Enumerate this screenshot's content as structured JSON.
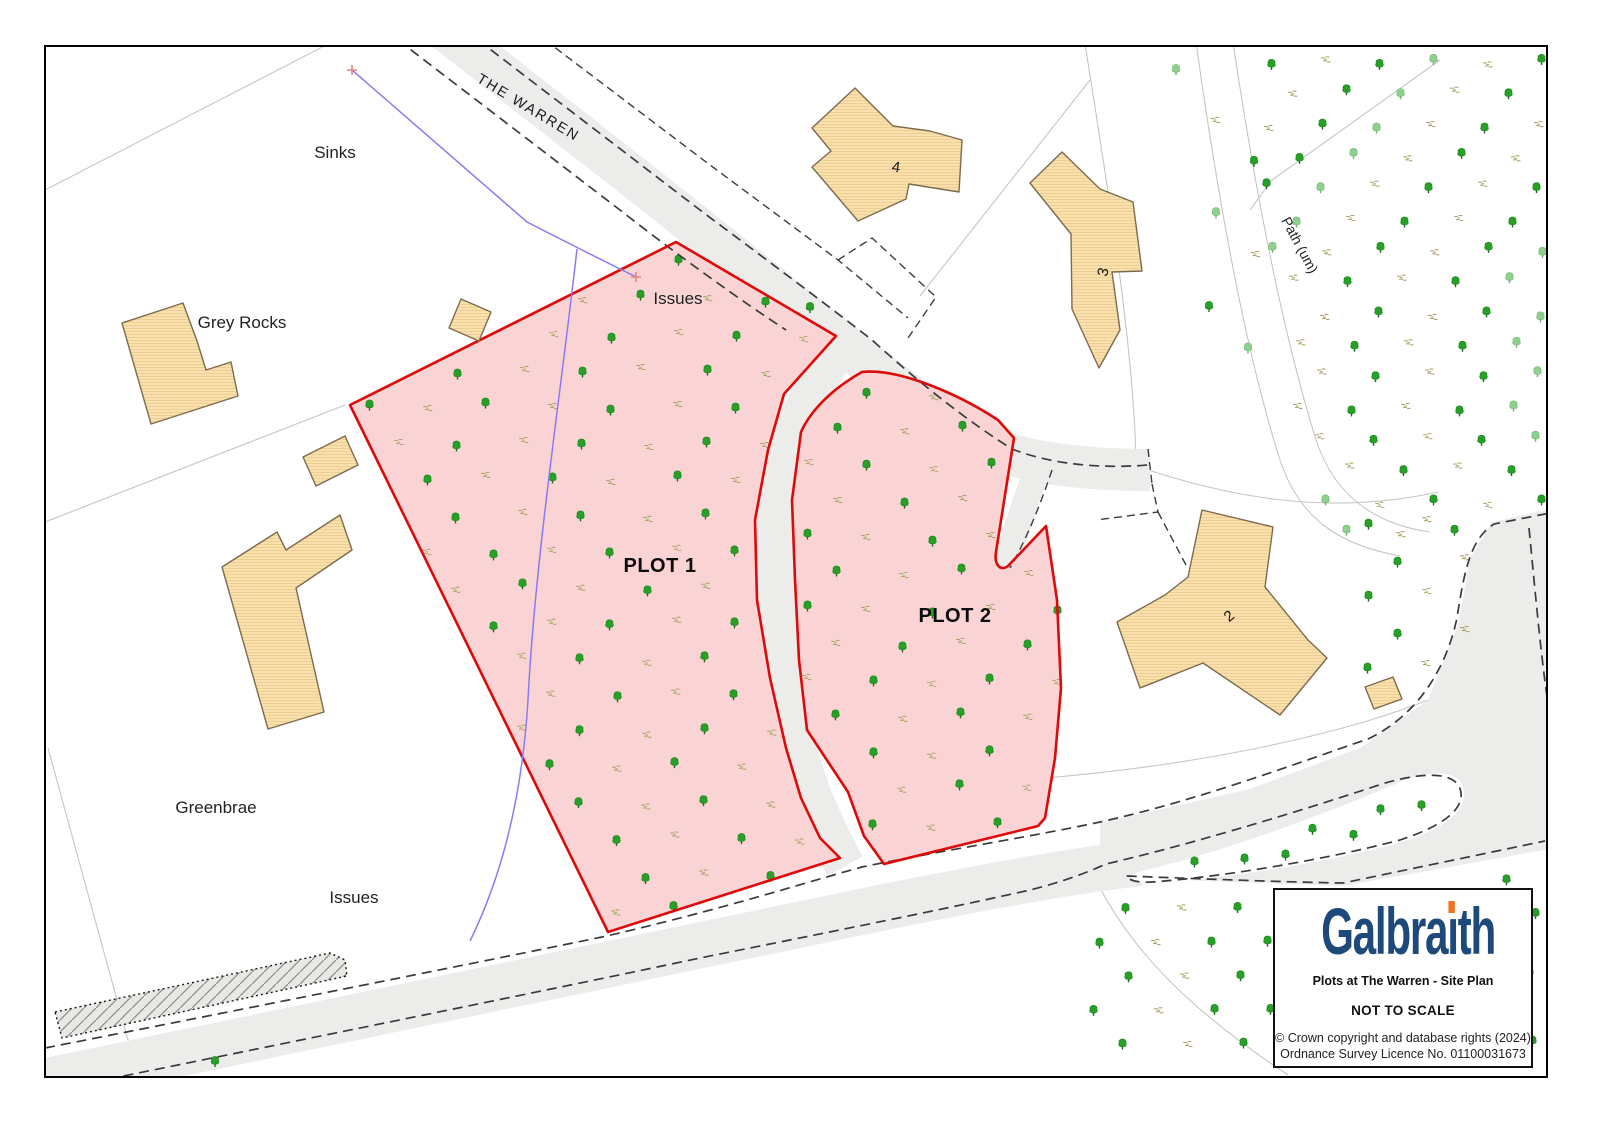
{
  "map": {
    "labels": {
      "the_warren": "THE WARREN",
      "path_um": "Path (um)",
      "sinks": "Sinks",
      "grey_rocks": "Grey Rocks",
      "greenbrae": "Greenbrae",
      "issues_top": "Issues",
      "issues_bottom": "Issues",
      "plot1": "PLOT 1",
      "plot2": "PLOT 2",
      "bldg2": "2",
      "bldg3": "3",
      "bldg4": "4"
    },
    "colors": {
      "plot_fill": "#fad4d4",
      "plot_border": "#de0a0a",
      "building_fill": "#f9e0ad",
      "building_stroke": "#7d6b4f",
      "road_fill": "#ececea",
      "road_border": "#3b3b3b",
      "boundary_gray": "#c6c6c4",
      "water_line": "#8b7bf0",
      "tree_green": "#28a028",
      "tree_light_green": "#8fd08f",
      "scrub_tan": "#b5a26b"
    },
    "vegetation": [
      {
        "name": "plot1-trees",
        "spacing": 62,
        "symbols": [
          "tree",
          "scrub"
        ],
        "points": [
          [
            350,
            405
          ],
          [
            676,
            242
          ],
          [
            836,
            336
          ],
          [
            784,
            394
          ],
          [
            768,
            450
          ],
          [
            755,
            520
          ],
          [
            757,
            600
          ],
          [
            770,
            678
          ],
          [
            786,
            748
          ],
          [
            801,
            798
          ],
          [
            820,
            838
          ],
          [
            840,
            858
          ],
          [
            608,
            932
          ]
        ]
      },
      {
        "name": "plot2-trees",
        "spacing": 62,
        "symbols": [
          "tree",
          "scrub"
        ],
        "points": [
          [
            862,
            372
          ],
          [
            935,
            388
          ],
          [
            998,
            420
          ],
          [
            1014,
            438
          ],
          [
            996,
            552
          ],
          [
            1008,
            566
          ],
          [
            1046,
            526
          ],
          [
            1057,
            600
          ],
          [
            1061,
            688
          ],
          [
            1055,
            758
          ],
          [
            1045,
            818
          ],
          [
            884,
            864
          ],
          [
            864,
            836
          ],
          [
            848,
            792
          ],
          [
            807,
            730
          ],
          [
            799,
            660
          ],
          [
            795,
            580
          ],
          [
            792,
            500
          ],
          [
            801,
            432
          ],
          [
            831,
            390
          ]
        ]
      },
      {
        "name": "northeast-woodland",
        "spacing": 54,
        "symbols": [
          "tree",
          "scrub",
          "tree",
          "treeLight",
          "scrub"
        ],
        "points": [
          [
            1256,
            44
          ],
          [
            1544,
            44
          ],
          [
            1544,
            506
          ],
          [
            1478,
            534
          ],
          [
            1400,
            556
          ],
          [
            1332,
            548
          ],
          [
            1300,
            428
          ],
          [
            1266,
            208
          ]
        ]
      },
      {
        "name": "path-west-scatter",
        "spacing": 80,
        "symbols": [
          "treeLight",
          "scrub",
          "tree"
        ],
        "points": [
          [
            1152,
            44
          ],
          [
            1248,
            44
          ],
          [
            1260,
            205
          ],
          [
            1292,
            420
          ],
          [
            1238,
            428
          ],
          [
            1183,
            258
          ]
        ]
      },
      {
        "name": "east-garden-trees",
        "spacing": 62,
        "symbols": [
          "tree",
          "scrub"
        ],
        "points": [
          [
            1352,
            512
          ],
          [
            1468,
            502
          ],
          [
            1468,
            695
          ],
          [
            1358,
            678
          ]
        ]
      },
      {
        "name": "southeast-trees",
        "spacing": 58,
        "symbols": [
          "tree",
          "tree",
          "scrub",
          "tree"
        ],
        "points": [
          [
            1082,
            900
          ],
          [
            1340,
            892
          ],
          [
            1544,
            856
          ],
          [
            1544,
            1070
          ],
          [
            1082,
            1070
          ]
        ]
      },
      {
        "name": "road-loop-trees",
        "spacing": 46,
        "symbols": [
          "tree"
        ],
        "points": [
          [
            1138,
            870
          ],
          [
            1250,
            844
          ],
          [
            1360,
            810
          ],
          [
            1428,
            790
          ],
          [
            1446,
            800
          ],
          [
            1426,
            824
          ],
          [
            1330,
            852
          ],
          [
            1205,
            872
          ]
        ]
      }
    ],
    "extra_trees": [
      [
        215,
        1062
      ],
      [
        810,
        308
      ]
    ]
  },
  "info_box": {
    "brand": "Galbraith",
    "brand_color": "#1d4a7a",
    "brand_accent": "#ee7320",
    "title": "Plots at The Warren - Site Plan",
    "scale_note": "NOT TO SCALE",
    "copyright1": "© Crown copyright and database rights (2024)",
    "copyright2": "Ordnance Survey Licence No. 01100031673"
  }
}
